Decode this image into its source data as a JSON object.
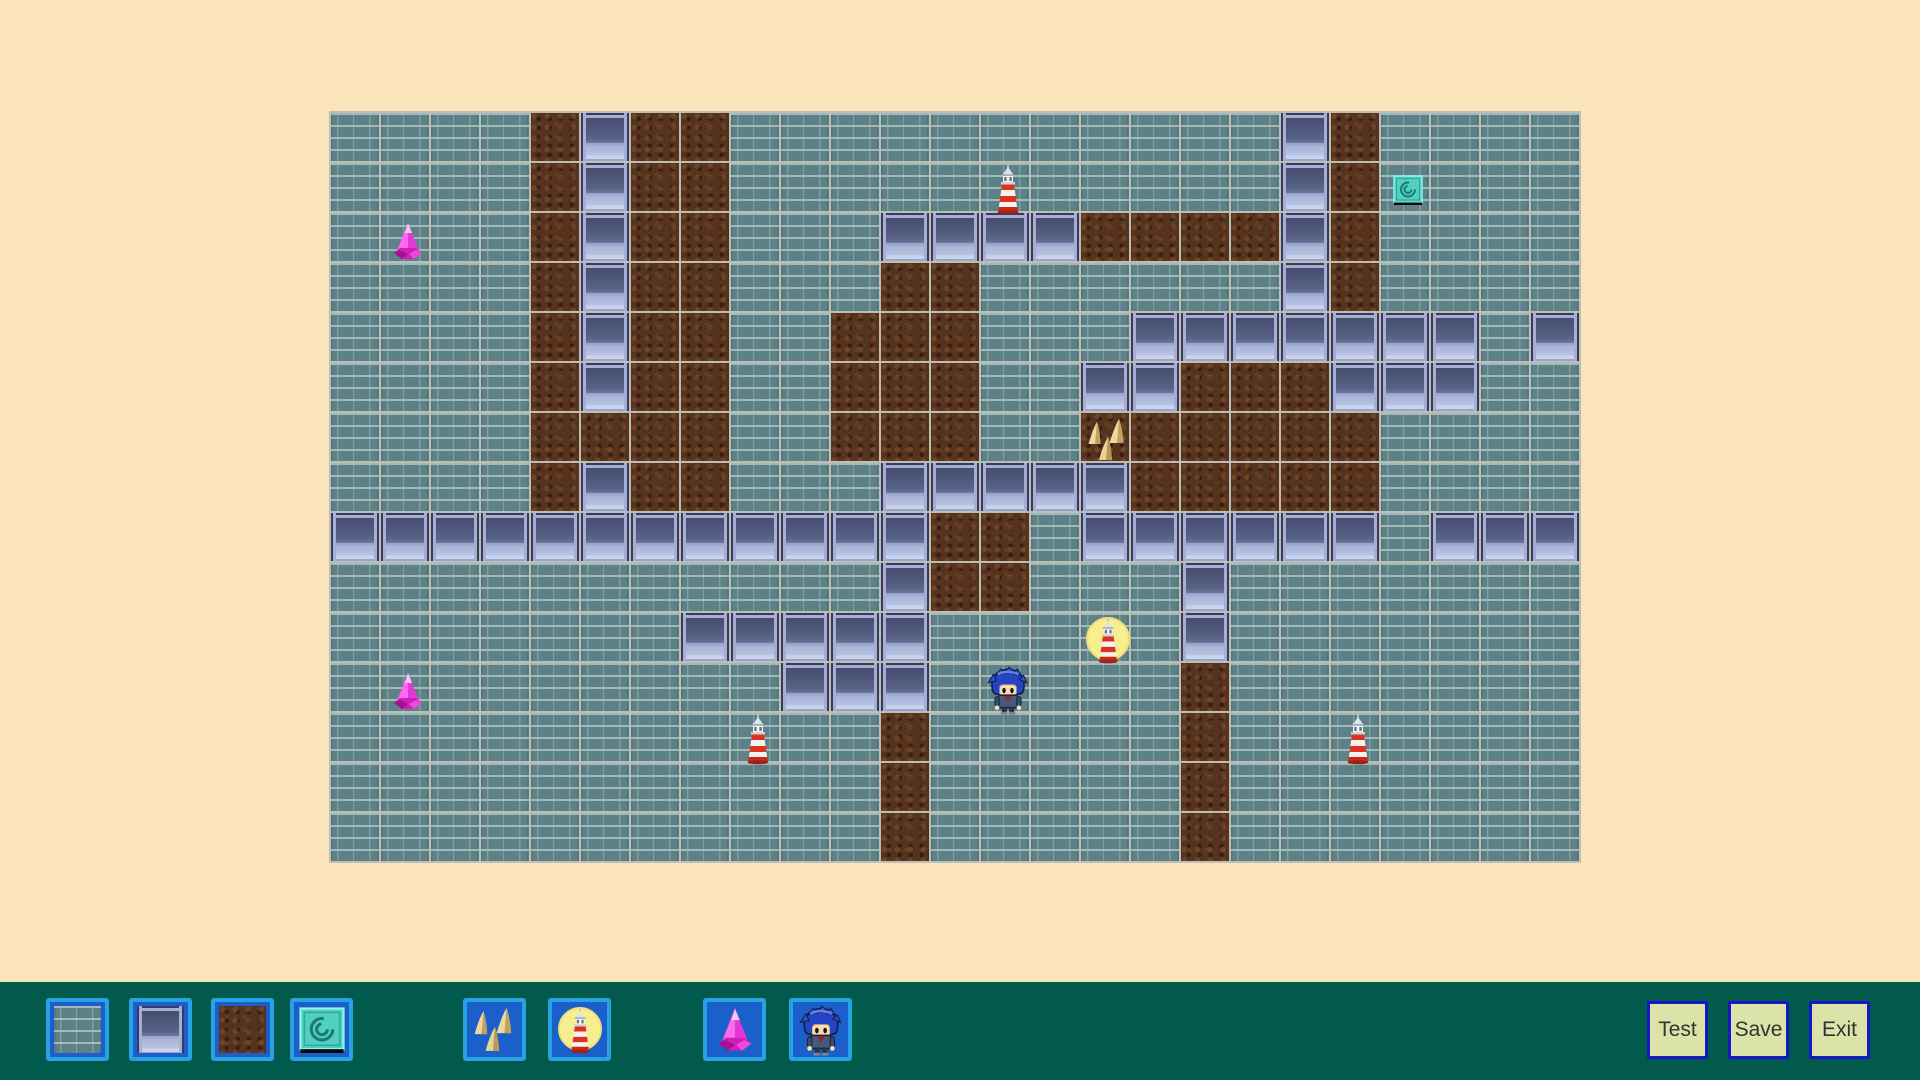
{
  "map": {
    "cols": 25,
    "rows": 15,
    "tile_size": 50,
    "legend": {
      "S": "stone-brick",
      "D": "dirt",
      "P": "metal-panel"
    },
    "tiles": [
      "SSSSDPDDSSSSSSSSSSSPDSSSS",
      "SSSSDPDDSSSSSSSSSSSPDSSSS",
      "SSSSDPDDSSSPPPPDDDDPDSSSS",
      "SSSSDPDDSSSDDSSSSSSPDSSSS",
      "SSSSDPDDSSDDDSSSPPPPPPPSP",
      "SSSSDPDDSSDDDSSPPDDDPPPSS",
      "SSSSDDDDSSDDDSSDDDDDDSSSS",
      "SSSSDPDDSSSPPPPPDDDDDSSSS",
      "PPPPPPPPPPPPDDSPPPPPPSPPP",
      "SSSSSSSSSSSPDDSSSPSSSSSSS",
      "SSSSSSSPPPPPSSSSSPSSSSSSS",
      "SSSSSSSSSPPPSSSSSDSSSSSSS",
      "SSSSSSSSSSSDSSSSSDSSSSSSS",
      "SSSSSSSSSSSDSSSSSDSSSSSSS",
      "SSSSSSSSSSSDSSSSSDSSSSSSS"
    ],
    "sprites": [
      {
        "type": "gem",
        "col": 1,
        "row": 2
      },
      {
        "type": "gem",
        "col": 1,
        "row": 11
      },
      {
        "type": "lighthouse",
        "col": 13,
        "row": 1
      },
      {
        "type": "lighthouse",
        "col": 8,
        "row": 12
      },
      {
        "type": "lighthouse",
        "col": 20,
        "row": 12
      },
      {
        "type": "lighthouse-lit",
        "col": 15,
        "row": 10
      },
      {
        "type": "spikes",
        "col": 15,
        "row": 6
      },
      {
        "type": "spiral-tile",
        "col": 21,
        "row": 1
      },
      {
        "type": "character",
        "col": 13,
        "row": 11
      }
    ]
  },
  "toolbar": {
    "palette": [
      {
        "name": "stone-brick-tile-button",
        "kind": "tile",
        "tile": "S",
        "margin": 46
      },
      {
        "name": "metal-panel-tile-button",
        "kind": "tile",
        "tile": "P",
        "margin": 20
      },
      {
        "name": "dirt-tile-button",
        "kind": "tile",
        "tile": "D",
        "margin": 19
      },
      {
        "name": "spiral-tile-button",
        "kind": "sprite",
        "sprite": "spiral-tile",
        "margin": 16
      },
      {
        "name": "spikes-button",
        "kind": "sprite",
        "sprite": "spikes",
        "margin": 110
      },
      {
        "name": "lit-lighthouse-button",
        "kind": "sprite",
        "sprite": "lighthouse-lit",
        "margin": 22
      },
      {
        "name": "gem-button",
        "kind": "sprite",
        "sprite": "gem",
        "margin": 92
      },
      {
        "name": "player-character-button",
        "kind": "sprite",
        "sprite": "character",
        "margin": 23
      }
    ],
    "actions": [
      {
        "label": "Test"
      },
      {
        "label": "Save"
      },
      {
        "label": "Exit"
      }
    ]
  },
  "colors": {
    "background": "#fbe3bb",
    "toolbar": "#015a4b",
    "grid_line": "#bdbfb5",
    "palette_border": "#29a2e4",
    "palette_fill": "#1b5fcb",
    "action_bg": "#dbe3a8",
    "action_border": "#1717c9"
  }
}
